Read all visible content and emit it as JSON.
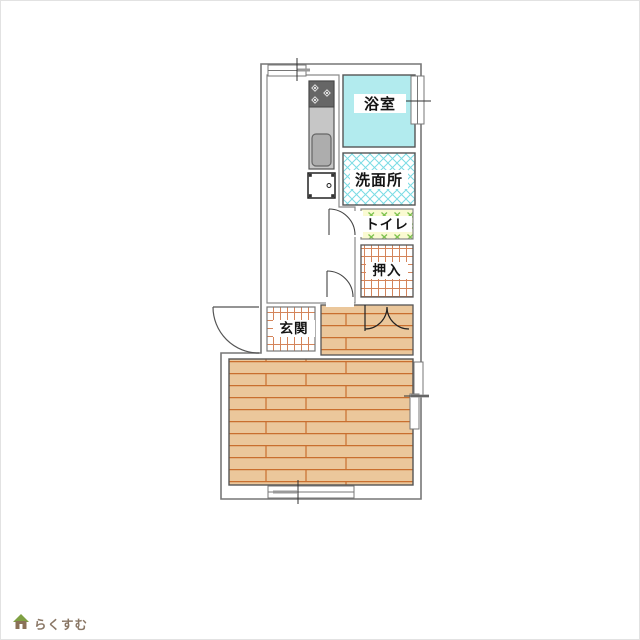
{
  "page": {
    "background": "#FFFFFF"
  },
  "logo": {
    "text": "らくすむ",
    "text_color": "#8A7766",
    "roof_color": "#7FA043",
    "body_color": "#8A7158"
  },
  "floorplan": {
    "rooms": {
      "bath": {
        "label": "浴室"
      },
      "washroom": {
        "label": "洗面所"
      },
      "toilet": {
        "label": "トイレ"
      },
      "closet": {
        "label": "押入"
      },
      "genkan": {
        "label": "玄関"
      }
    },
    "symbols": {
      "stove": "gas-stove-3-burner",
      "sink": "kitchen-sink",
      "washer": "washing-machine-pan",
      "windows": [
        "top-window",
        "bath-side-window",
        "living-side-window",
        "living-bottom-window"
      ],
      "doors": [
        "entrance-swing-door",
        "toilet-swing-door",
        "hall-swing-door",
        "closet-double-door"
      ]
    },
    "colors": {
      "wall": "#777777",
      "bath_fill": "#B2EBEE",
      "washroom_hatch": "#7ADCE4",
      "toilet_bg": "#FAFAD2",
      "toilet_hatch": "#7CC24E",
      "tile_grid": "#D4845A",
      "wood_fill": "#EBC79B",
      "wood_line": "#C96F2F",
      "counter": "#C6C6C6",
      "stove": "#666666",
      "sink": "#ADADAD"
    }
  }
}
